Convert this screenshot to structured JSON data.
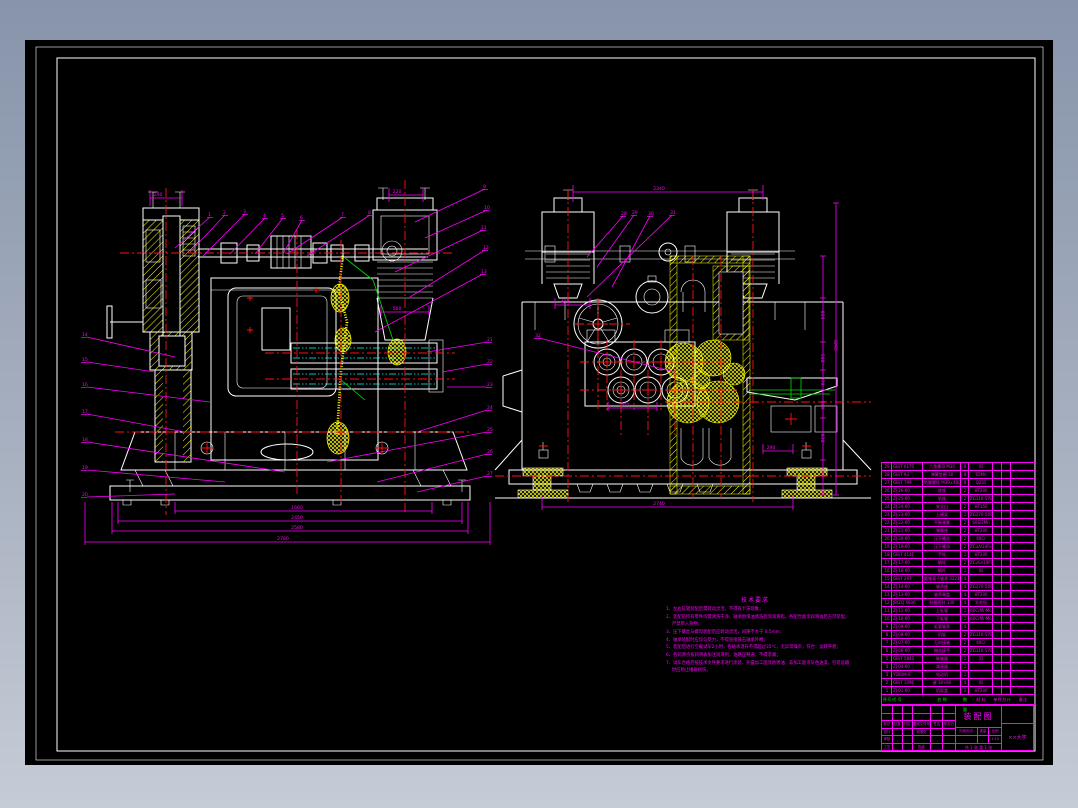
{
  "app": {
    "background_top": "#8794aa",
    "background_bottom": "#c6ccd6",
    "canvas_color": "#000000"
  },
  "colors": {
    "outline": "#ffffff",
    "dimension": "#ff00ff",
    "centerline": "#ff1111",
    "hidden": "#00ffff",
    "hatch": "#ffff00",
    "accent": "#00e000"
  },
  "notes": {
    "title": "技术要求",
    "items": [
      "1、左右轧辊装配后需转动灵活，不得有卡滞现象；",
      "2、装配前所有零件均需清洗干净，轴承用煤油清洗后涂润滑脂，各配合面涂润滑油后方可装配，严禁带入杂物；",
      "3、压下螺丝与螺母装配后应转动灵活，间隙不大于 0.5mm；",
      "4、轴承装配时应均匀受力，不得直接锤击轴承外圈；",
      "5、装配后进行空载试车2小时，各轴承温升不得超过35℃，无异常噪声，符合：运转平稳；",
      "6、各润滑点按润滑表加注润滑剂，油路应畅通，不得渗漏；",
      "7、试车合格后按技术文件要求进行涂装，外露加工面涂防锈油，非加工面涂灰色油漆，包装运输时应防止磕碰损伤。"
    ]
  },
  "parts_table": {
    "headers": [
      "序号",
      "代  号",
      "名  称",
      "数量",
      "材  料",
      "单件",
      "总计",
      "备注"
    ],
    "rows": [
      [
        "29",
        "GB/T 6170",
        "六角螺母 M30",
        "8",
        "45",
        "",
        "",
        ""
      ],
      [
        "28",
        "GB/T 93",
        "弹簧垫圈 30",
        "8",
        "65Mn",
        "",
        "",
        ""
      ],
      [
        "27",
        "GB/T 799",
        "地脚螺栓 M30×400",
        "8",
        "Q235",
        "",
        "",
        ""
      ],
      [
        "26",
        "ZJ-26-00",
        "底座",
        "2",
        "HT200",
        "",
        "",
        ""
      ],
      [
        "25",
        "ZJ-25-00",
        "轨座",
        "2",
        "ZG310-570",
        "",
        "",
        ""
      ],
      [
        "24",
        "ZJ-24-00",
        "安全臼",
        "2",
        "HT150",
        "",
        "",
        ""
      ],
      [
        "23",
        "ZJ-23-00",
        "上横梁",
        "1",
        "ZG270-500",
        "",
        "",
        ""
      ],
      [
        "22",
        "ZJ-22-00",
        "平衡弹簧",
        "2",
        "60Si2Mn",
        "",
        "",
        ""
      ],
      [
        "21",
        "ZJ-21-00",
        "弹簧座",
        "2",
        "HT200",
        "",
        "",
        ""
      ],
      [
        "20",
        "ZJ-20-00",
        "压下螺丝",
        "2",
        "40Cr",
        "",
        "",
        ""
      ],
      [
        "19",
        "ZJ-19-00",
        "压下螺母",
        "2",
        "ZCuAl10Fe3",
        "",
        "",
        ""
      ],
      [
        "18",
        "GB/T 4141",
        "手轮",
        "1",
        "HT200",
        "",
        "",
        ""
      ],
      [
        "17",
        "ZJ-17-00",
        "蜗轮",
        "2",
        "ZCuSn10P1",
        "",
        "",
        ""
      ],
      [
        "16",
        "ZJ-16-00",
        "蜗杆",
        "1",
        "45",
        "",
        "",
        ""
      ],
      [
        "15",
        "GB/T 297",
        "圆锥滚子轴承 32230",
        "4",
        "",
        "",
        "",
        ""
      ],
      [
        "14",
        "ZJ-14-00",
        "轴承座",
        "4",
        "ZG270-500",
        "",
        "",
        ""
      ],
      [
        "13",
        "ZJ-13-00",
        "轴承端盖",
        "4",
        "HT200",
        "",
        "",
        ""
      ],
      [
        "12",
        "JB/ZQ 4606",
        "毡圈密封 130",
        "4",
        "羊毛毡",
        "",
        "",
        ""
      ],
      [
        "11",
        "ZJ-11-00",
        "上轧辊",
        "1",
        "60CrMnMo",
        "",
        "",
        ""
      ],
      [
        "10",
        "ZJ-10-00",
        "下轧辊",
        "1",
        "60CrMnMo",
        "",
        "",
        ""
      ],
      [
        "9",
        "ZJ-09-00",
        "轧辊轴承",
        "4",
        "",
        "",
        "",
        ""
      ],
      [
        "8",
        "ZJ-08-00",
        "机架",
        "2",
        "ZG310-570",
        "",
        "",
        ""
      ],
      [
        "7",
        "ZJ-07-00",
        "万向接轴",
        "2",
        "40Cr",
        "",
        "",
        ""
      ],
      [
        "6",
        "ZJ-06-00",
        "梅花接手",
        "2",
        "ZG310-570",
        "",
        "",
        ""
      ],
      [
        "5",
        "GB/T 5843",
        "联轴器",
        "1",
        "35",
        "",
        "",
        ""
      ],
      [
        "4",
        "ZJ-04-00",
        "减速器",
        "1",
        "",
        "",
        "",
        ""
      ],
      [
        "3",
        "Y280M-6",
        "电动机",
        "1",
        "",
        "",
        "",
        ""
      ],
      [
        "2",
        "GB/T 1096",
        "键 18×80",
        "4",
        "45",
        "",
        "",
        ""
      ],
      [
        "1",
        "ZJ-01-00",
        "机架盖",
        "2",
        "HT200",
        "",
        "",
        ""
      ]
    ]
  },
  "title_block": {
    "grid": [
      [
        "",
        "",
        "",
        "",
        "",
        ""
      ],
      [
        "",
        "",
        "",
        "",
        "",
        ""
      ],
      [
        "标记",
        "处数",
        "分区",
        "更改文件号",
        "签名",
        "年月日"
      ],
      [
        "设计",
        "",
        "",
        "标准化",
        "",
        ""
      ],
      [
        "审核",
        "",
        "",
        "",
        "",
        ""
      ],
      [
        "工艺",
        "",
        "",
        "批准",
        "",
        ""
      ]
    ],
    "title": "装配图",
    "mid_labels": [
      "阶段标记",
      "重量",
      "比例"
    ],
    "scale": "1:10",
    "sheet": "共 1 张  第 1 张",
    "org": "××大学"
  },
  "balloons": [
    [
      "1",
      183,
      176
    ],
    [
      "2",
      198,
      174
    ],
    [
      "3",
      218,
      173
    ],
    [
      "4",
      238,
      177
    ],
    [
      "5",
      256,
      177
    ],
    [
      "6",
      275,
      179
    ],
    [
      "7",
      316,
      176
    ],
    [
      "8",
      343,
      174
    ],
    [
      "9",
      458,
      148
    ],
    [
      "10",
      459,
      169
    ],
    [
      "11",
      456,
      189
    ],
    [
      "12",
      458,
      209
    ],
    [
      "13",
      456,
      233
    ],
    [
      "14",
      57,
      296
    ],
    [
      "15",
      57,
      321
    ],
    [
      "16",
      57,
      346
    ],
    [
      "17",
      57,
      373
    ],
    [
      "18",
      57,
      401
    ],
    [
      "19",
      57,
      429
    ],
    [
      "20",
      57,
      456
    ],
    [
      "21",
      462,
      301
    ],
    [
      "22",
      462,
      323
    ],
    [
      "23",
      462,
      346
    ],
    [
      "24",
      462,
      369
    ],
    [
      "25",
      462,
      391
    ],
    [
      "26",
      462,
      413
    ],
    [
      "27",
      462,
      435
    ],
    [
      "28",
      596,
      175
    ],
    [
      "29",
      607,
      174
    ],
    [
      "30",
      623,
      175
    ],
    [
      "31",
      645,
      174
    ],
    [
      "32",
      510,
      297
    ]
  ],
  "dim_labels": [
    [
      "1660",
      272,
      469,
      0
    ],
    [
      "2450",
      272,
      479,
      0
    ],
    [
      "2580",
      272,
      489,
      0
    ],
    [
      "2780",
      258,
      500,
      0
    ],
    [
      "240",
      133,
      156,
      0
    ],
    [
      "220",
      372,
      153,
      0
    ],
    [
      "560",
      372,
      270,
      0
    ],
    [
      "2340",
      634,
      150,
      0
    ],
    [
      "2740",
      634,
      465,
      0
    ],
    [
      "480",
      540,
      263,
      0
    ],
    [
      "500",
      600,
      366,
      0
    ],
    [
      "290",
      746,
      409,
      0
    ],
    [
      "850",
      796,
      275,
      1
    ],
    [
      "560",
      796,
      318,
      1
    ],
    [
      "370",
      796,
      341,
      1
    ],
    [
      "540",
      796,
      365,
      1
    ],
    [
      "830",
      796,
      398,
      1
    ],
    [
      "3295",
      809,
      305,
      1
    ]
  ]
}
